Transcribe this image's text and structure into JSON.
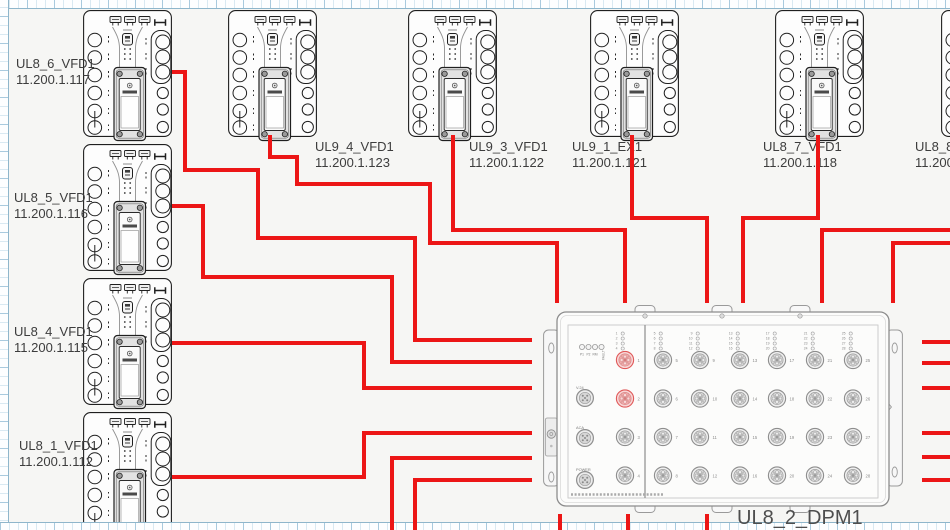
{
  "canvas": {
    "page_bg": "#f6f6f4",
    "grid_line_color": "#a9cade",
    "device_outline_color": "#1f1f1f",
    "dpm_outline_color": "#8d8d8d"
  },
  "devices": [
    {
      "name": "UL8_6_VFD1",
      "ip": "11.200.1.117"
    },
    {
      "name": "UL8_5_VFD1",
      "ip": "11.200.1.116"
    },
    {
      "name": "UL8_4_VFD1",
      "ip": "11.200.1.115"
    },
    {
      "name": "UL8_1_VFD1",
      "ip": "11.200.1.112"
    },
    {
      "name": "UL9_4_VFD1",
      "ip": "11.200.1.123"
    },
    {
      "name": "UL9_3_VFD1",
      "ip": "11.200.1.122"
    },
    {
      "name": "UL9_1_EX1",
      "ip": "11.200.1.121"
    },
    {
      "name": "UL8_7_VFD1",
      "ip": "11.200.1.118"
    },
    {
      "name": "UL8_8_V",
      "ip": "11.200."
    }
  ],
  "dpm": {
    "label": "UL8_2_DPM1",
    "status_leds": [
      "P1",
      "P2",
      "RM",
      "FAULT"
    ],
    "aux_connectors": [
      "V.24",
      "ACA",
      "POWER"
    ],
    "left_ports": [
      1,
      2,
      3,
      4
    ],
    "highlighted_ports": [
      1,
      2
    ],
    "grid_ports": [
      [
        5,
        6,
        7,
        8
      ],
      [
        9,
        10,
        11,
        12
      ],
      [
        13,
        14,
        15,
        16
      ],
      [
        17,
        18,
        19,
        20
      ],
      [
        21,
        22,
        23,
        24
      ],
      [
        25,
        26,
        27,
        28
      ]
    ],
    "colors": {
      "port": "#8e8e8e",
      "port_active": "#e05a5a",
      "tiny_text": "#8a8a8a"
    }
  },
  "cables": {
    "color": "#ec1616",
    "width": 4,
    "routes": [
      [
        [
          172,
          72
        ],
        [
          185,
          72
        ],
        [
          185,
          170
        ],
        [
          258,
          170
        ],
        [
          258,
          238
        ],
        [
          415,
          238
        ],
        [
          415,
          340
        ],
        [
          532,
          340
        ]
      ],
      [
        [
          172,
          206
        ],
        [
          203,
          206
        ],
        [
          203,
          277
        ],
        [
          392,
          277
        ],
        [
          392,
          362
        ],
        [
          532,
          362
        ]
      ],
      [
        [
          172,
          343
        ],
        [
          364,
          343
        ],
        [
          364,
          388
        ],
        [
          532,
          388
        ]
      ],
      [
        [
          172,
          477
        ],
        [
          364,
          477
        ],
        [
          364,
          433
        ],
        [
          532,
          433
        ]
      ],
      [
        [
          392,
          532
        ],
        [
          392,
          458
        ],
        [
          532,
          458
        ]
      ],
      [
        [
          415,
          532
        ],
        [
          415,
          480
        ],
        [
          532,
          480
        ]
      ],
      [
        [
          270,
          135
        ],
        [
          270,
          157
        ],
        [
          297,
          157
        ],
        [
          297,
          184
        ],
        [
          430,
          184
        ],
        [
          430,
          243
        ],
        [
          557,
          243
        ],
        [
          557,
          303
        ]
      ],
      [
        [
          453,
          135
        ],
        [
          453,
          230
        ],
        [
          625,
          230
        ],
        [
          625,
          303
        ]
      ],
      [
        [
          632,
          135
        ],
        [
          632,
          218
        ],
        [
          707,
          218
        ],
        [
          707,
          303
        ]
      ],
      [
        [
          818,
          135
        ],
        [
          818,
          218
        ],
        [
          743,
          218
        ],
        [
          743,
          303
        ]
      ],
      [
        [
          952,
          230
        ],
        [
          822,
          230
        ],
        [
          822,
          303
        ]
      ],
      [
        [
          952,
          243
        ],
        [
          893,
          243
        ],
        [
          893,
          303
        ]
      ],
      [
        [
          922,
          342
        ],
        [
          952,
          342
        ]
      ],
      [
        [
          922,
          363
        ],
        [
          952,
          363
        ]
      ],
      [
        [
          922,
          388
        ],
        [
          952,
          388
        ]
      ],
      [
        [
          922,
          433
        ],
        [
          952,
          433
        ]
      ],
      [
        [
          922,
          457
        ],
        [
          952,
          457
        ]
      ],
      [
        [
          922,
          480
        ],
        [
          952,
          480
        ]
      ],
      [
        [
          560,
          514
        ],
        [
          560,
          531
        ]
      ],
      [
        [
          628,
          514
        ],
        [
          628,
          531
        ]
      ],
      [
        [
          707,
          514
        ],
        [
          707,
          531
        ]
      ]
    ]
  }
}
